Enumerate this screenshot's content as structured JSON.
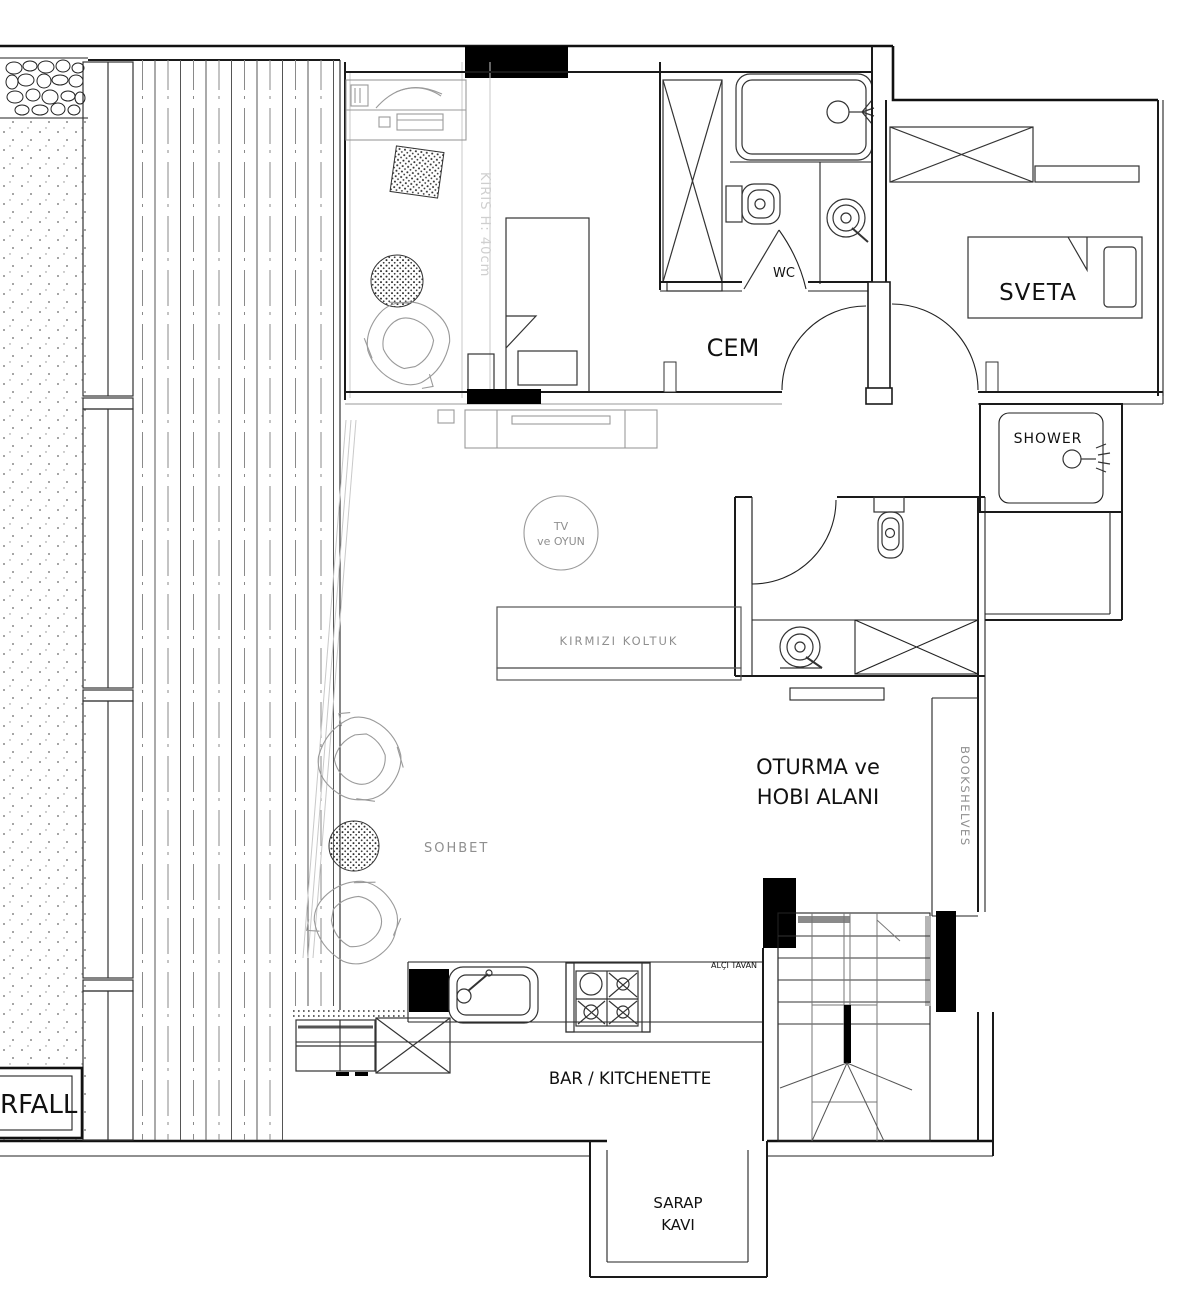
{
  "title": "apartment-floor-plan",
  "labels": {
    "cem": "CEM",
    "sveta": "SVETA",
    "wc": "WC",
    "shower": "SHOWER",
    "oturma1": "OTURMA ve",
    "oturma2": "HOBI ALANI",
    "bookshelves": "BOOKSHELVES",
    "bar": "BAR / KITCHENETTE",
    "sarap1": "SARAP",
    "sarap2": "KAVI",
    "waterfall": "RFALL",
    "sohbet": "SOHBET",
    "sofa": "KIRMIZI KOLTUK",
    "tv1": "TV",
    "tv2": "ve OYUN",
    "beam": "KIRIS H: 40cm",
    "ceiling": "ALÇI TAVAN"
  },
  "colors": {
    "wall": "#1a1a1a",
    "furniture_gray": "#9a9a9a",
    "light_gray": "#c9c9c9",
    "text_dark": "#111111",
    "text_gray": "#8f8f8f",
    "beam_text": "#cfcfcf",
    "fill_black": "#000000"
  }
}
